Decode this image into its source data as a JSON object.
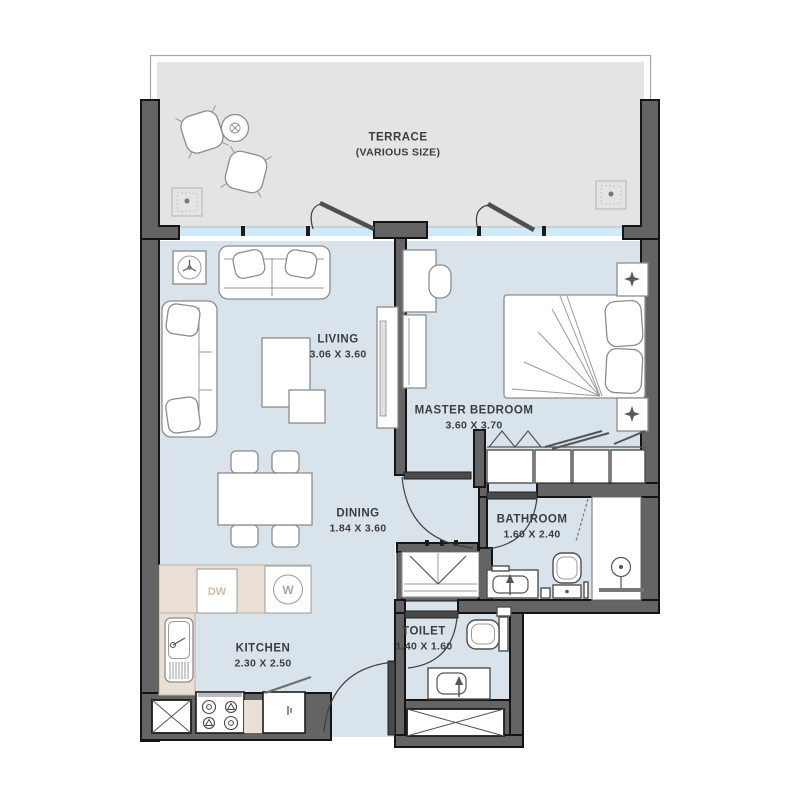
{
  "title": "Apartment floor plan",
  "colors": {
    "wall": "#646464",
    "wall_line": "#141414",
    "floor": "#d9e3eb",
    "terrace_floor": "#e4e4e2",
    "counter": "#eadfd5",
    "window": "#cfeaf6",
    "label_text": "#3d3d3d"
  },
  "rooms": [
    {
      "id": "terrace",
      "name": "TERRACE",
      "dims": "(VARIOUS SIZE)"
    },
    {
      "id": "living",
      "name": "LIVING",
      "dims": "3.06 X 3.60"
    },
    {
      "id": "master-bedroom",
      "name": "MASTER BEDROOM",
      "dims": "3.60 X 3.70"
    },
    {
      "id": "dining",
      "name": "DINING",
      "dims": "1.84 X 3.60"
    },
    {
      "id": "bathroom",
      "name": "BATHROOM",
      "dims": "1.60 X 2.40"
    },
    {
      "id": "kitchen",
      "name": "KITCHEN",
      "dims": "2.30 X 2.50"
    },
    {
      "id": "toilet",
      "name": "TOILET",
      "dims": "1.40 X 1.60"
    }
  ],
  "appliances": {
    "dishwasher_label": "DW",
    "washer_label": "W"
  }
}
